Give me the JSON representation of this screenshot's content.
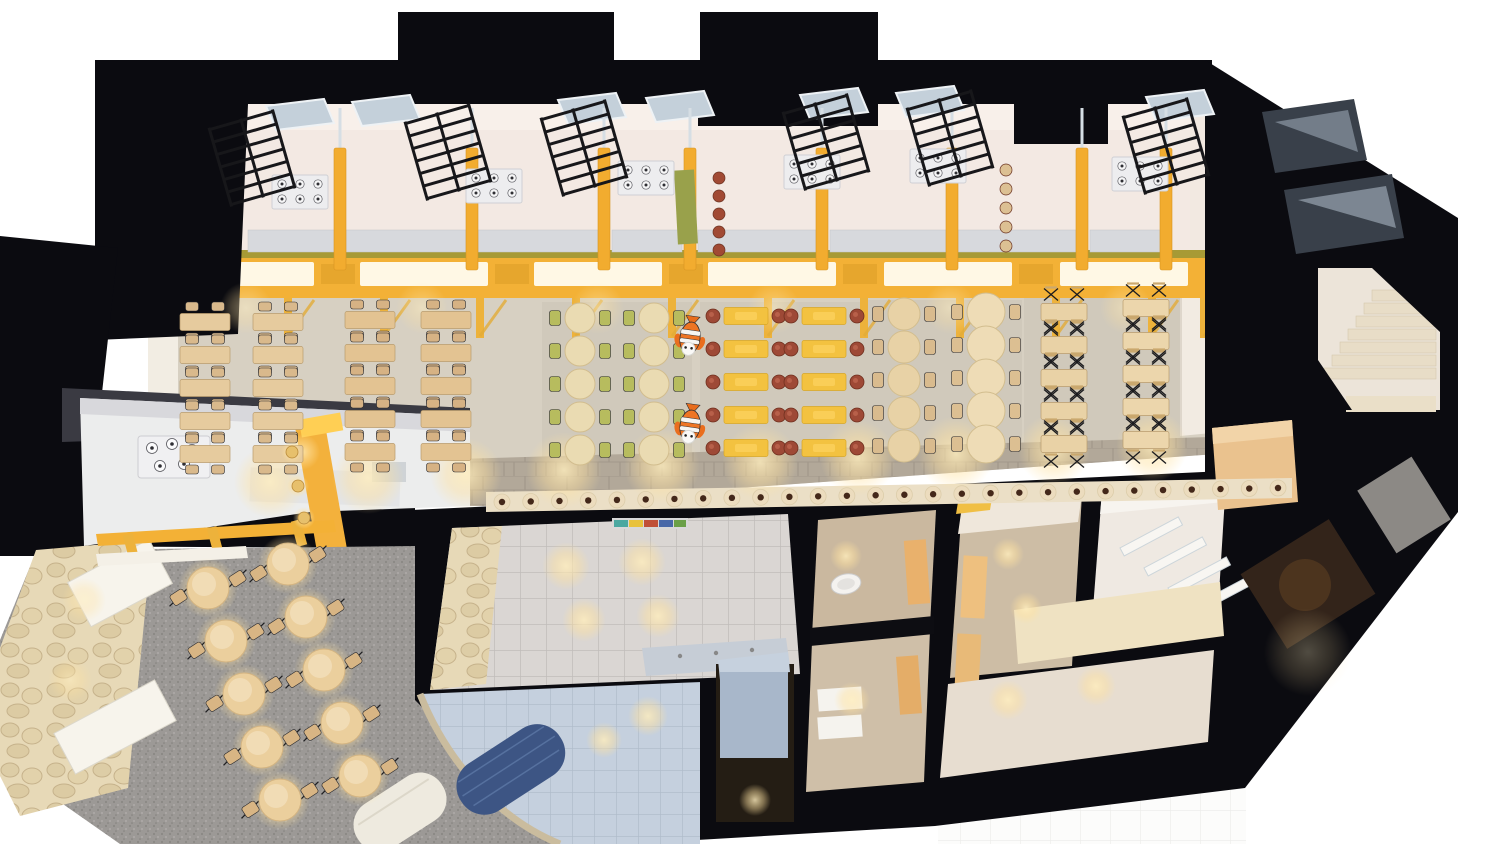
{
  "palette": {
    "wall": "#0b0b10",
    "wallSoft": "#3a3a42",
    "frame": "#f3b136",
    "canopyTop": "#a79a35",
    "lightPanel": "#fffbec",
    "kitchenFloor": "#f3e9e3",
    "hallFloor": "#d7d0c2",
    "walkway": "#b2a899",
    "bench": "#ebdfc6",
    "stoneWall": "#e7d9b7",
    "terrazzo": "#9c9996",
    "washTile": "#d9d5d2",
    "blueTile": "#c5d0de",
    "navyCylinder": "#3d5584",
    "greenChair": "#b7bc5e",
    "yellowTable": "#f3c240",
    "redStool": "#9e4936",
    "wood": "#e6cb9e",
    "mascotOrange": "#ee7524"
  },
  "scene": {
    "canopy": {
      "panels": [
        250,
        424,
        598,
        772,
        948,
        1124
      ],
      "panel_w": 128,
      "mesh": [
        338,
        512,
        686,
        860,
        1036
      ],
      "posts": [
        192,
        288,
        384,
        480,
        576,
        672,
        768,
        864,
        960,
        1056,
        1152,
        1204
      ]
    },
    "kitchen": {
      "dividers": [
        340,
        472,
        604,
        690,
        822,
        952,
        1082,
        1166
      ],
      "skylights": [
        [
          266,
          106
        ],
        [
          352,
          102
        ],
        [
          558,
          100
        ],
        [
          646,
          98
        ],
        [
          800,
          95
        ],
        [
          896,
          93
        ],
        [
          1146,
          97
        ]
      ],
      "racks": [
        [
          252,
          158
        ],
        [
          448,
          152
        ],
        [
          584,
          148
        ],
        [
          826,
          142
        ],
        [
          950,
          138
        ],
        [
          1166,
          146
        ]
      ],
      "stoves": [
        [
          300,
          192
        ],
        [
          494,
          186
        ],
        [
          646,
          178
        ],
        [
          812,
          172
        ],
        [
          938,
          166
        ],
        [
          1140,
          174
        ]
      ],
      "counters": [
        [
          248,
          336
        ],
        [
          346,
          466
        ],
        [
          478,
          598
        ],
        [
          612,
          682
        ],
        [
          698,
          816
        ],
        [
          830,
          946
        ],
        [
          958,
          1076
        ],
        [
          1090,
          1160
        ]
      ],
      "stool_cols": [
        {
          "x": 719,
          "y0": 178,
          "dy": 18,
          "n": 5,
          "c": "#a14a34"
        },
        {
          "x": 1006,
          "y0": 170,
          "dy": 19,
          "n": 5,
          "c": "#dcc093"
        }
      ],
      "green_shelf": [
        676,
        170,
        20,
        74
      ]
    },
    "dining_zones": [
      {
        "name": "dining-wood-a",
        "type": "rect4",
        "cols": [
          205,
          278
        ],
        "y0": 322,
        "dy": 33,
        "rows": 5,
        "tw": 50,
        "th": 17,
        "tc": "#e6cb9e",
        "sc": "#d9b98c"
      },
      {
        "name": "dining-wood-b",
        "type": "rect4",
        "cols": [
          370,
          446
        ],
        "y0": 320,
        "dy": 33,
        "rows": 5,
        "tw": 50,
        "th": 17,
        "tc": "#e3c392",
        "sc": "#d6b284"
      },
      {
        "name": "dining-green",
        "type": "round-side",
        "cols": [
          580,
          654
        ],
        "y0": 318,
        "dy": 33,
        "rows": 5,
        "r": 15,
        "tc": "#eadbb2",
        "sc": "#b7bc5e"
      },
      {
        "name": "dining-yellow",
        "type": "stool-rect",
        "cols": [
          746,
          824
        ],
        "y0": 316,
        "dy": 33,
        "rows": 5,
        "tw": 44,
        "th": 17,
        "tc": "#f3c240",
        "sc": "#9e4936"
      },
      {
        "name": "dining-round",
        "type": "round-side",
        "cols": [
          904
        ],
        "y0": 314,
        "dy": 33,
        "rows": 5,
        "r": 16,
        "tc": "#e8d2a6",
        "sc": "#d9bb8e"
      },
      {
        "name": "dining-oval",
        "type": "round-side",
        "cols": [
          986
        ],
        "y0": 312,
        "dy": 33,
        "rows": 5,
        "r": 19,
        "tc": "#eedcb6",
        "sc": "#dcbf92"
      },
      {
        "name": "dining-x-a",
        "type": "xrect",
        "cols": [
          1064
        ],
        "y0": 312,
        "dy": 33,
        "rows": 5,
        "tw": 46,
        "th": 17,
        "tc": "#e9d2a6"
      },
      {
        "name": "dining-x-b",
        "type": "xrect",
        "cols": [
          1146
        ],
        "y0": 308,
        "dy": 33,
        "rows": 5,
        "tw": 46,
        "th": 17,
        "tc": "#ecd6ac"
      }
    ],
    "stool_row": {
      "x1": 502,
      "y1": 502,
      "x2": 1278,
      "y2": 488,
      "n": 28
    },
    "cafe": {
      "origin": [
        208,
        588
      ],
      "dRow": [
        18,
        53
      ],
      "dCol": [
        80,
        -24
      ],
      "rows": 5,
      "cols": 2,
      "r": 21,
      "rot": -33
    },
    "mascots": [
      [
        690,
        338
      ],
      [
        690,
        426
      ]
    ],
    "light_pools": [
      [
        270,
        482,
        36
      ],
      [
        368,
        478,
        36
      ],
      [
        466,
        474,
        36
      ],
      [
        564,
        470,
        38
      ],
      [
        662,
        466,
        38
      ],
      [
        760,
        462,
        38
      ],
      [
        858,
        458,
        38
      ],
      [
        956,
        454,
        38
      ],
      [
        1054,
        450,
        36
      ],
      [
        1152,
        446,
        36
      ],
      [
        246,
        308,
        26,
        0.5
      ],
      [
        422,
        308,
        26,
        0.5
      ],
      [
        598,
        308,
        26,
        0.5
      ],
      [
        774,
        308,
        26,
        0.5
      ],
      [
        950,
        308,
        26,
        0.5
      ],
      [
        1126,
        308,
        26,
        0.5
      ],
      [
        566,
        566,
        24
      ],
      [
        642,
        562,
        24
      ],
      [
        584,
        620,
        22
      ],
      [
        658,
        616,
        22
      ],
      [
        846,
        556,
        16
      ],
      [
        852,
        700,
        18
      ],
      [
        1008,
        554,
        16
      ],
      [
        1026,
        608,
        16
      ],
      [
        1008,
        700,
        20
      ],
      [
        1096,
        686,
        20
      ],
      [
        648,
        716,
        20
      ],
      [
        604,
        740,
        18
      ],
      [
        755,
        800,
        16
      ],
      [
        1308,
        652,
        44,
        0.3
      ],
      [
        84,
        600,
        22,
        0.6
      ],
      [
        70,
        680,
        22,
        0.6
      ],
      [
        302,
        452,
        18
      ]
    ]
  }
}
